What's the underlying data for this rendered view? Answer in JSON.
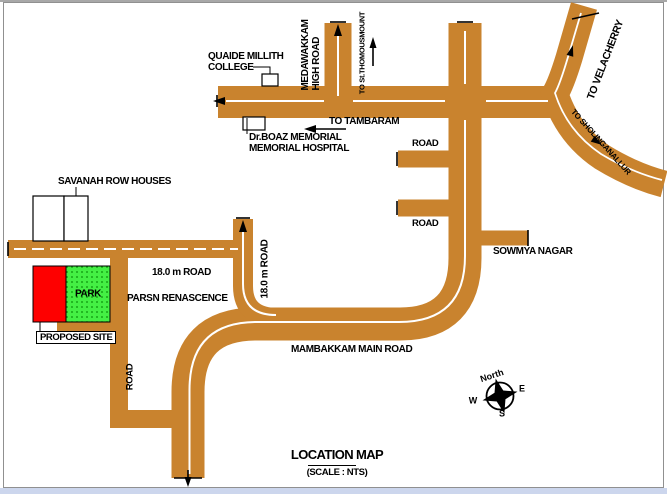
{
  "map": {
    "title": "LOCATION MAP",
    "scale_note": "(SCALE : NTS)",
    "labels": {
      "college_line1": "QUAIDE MILLITH",
      "college_line2": "COLLEGE",
      "high_road_line1": "MEDAWAKKAM",
      "high_road_line2": "HIGH ROAD",
      "to_st_thomas": "TO St.THOMOUSMOUNT",
      "to_tambaram": "TO TAMBARAM",
      "to_velacherry": "TO VELACHERRY",
      "to_sholinganallur": "TO SHOLINGANALLUR",
      "road_stub_upper": "ROAD",
      "road_stub_lower": "ROAD",
      "sowmya_nagar": "SOWMYA NAGAR",
      "hospital_line1": "Dr.BOAZ MEMORIAL",
      "hospital_line2": "MEMORIAL HOSPITAL",
      "savanah_row_houses": "SAVANAH ROW HOUSES",
      "road_18m_horizontal": "18.0 m ROAD",
      "road_18m_vertical": "18.0 m ROAD",
      "parsn_renascence": "PARSN RENASCENCE",
      "park": "PARK",
      "proposed_site": "PROPOSED SITE",
      "road_vertical": "ROAD",
      "mambakkam_main_road": "MAMBAKKAM MAIN ROAD"
    },
    "compass": {
      "north": "North",
      "east": "E",
      "south": "S",
      "west": "W"
    },
    "colors": {
      "road": "#c9832e",
      "road_centerline": "#ffffff",
      "park_fill": "#44ef44",
      "park_dot": "#0a8f0a",
      "proposed_site_fill": "#fe0000",
      "ink": "#000000"
    }
  }
}
